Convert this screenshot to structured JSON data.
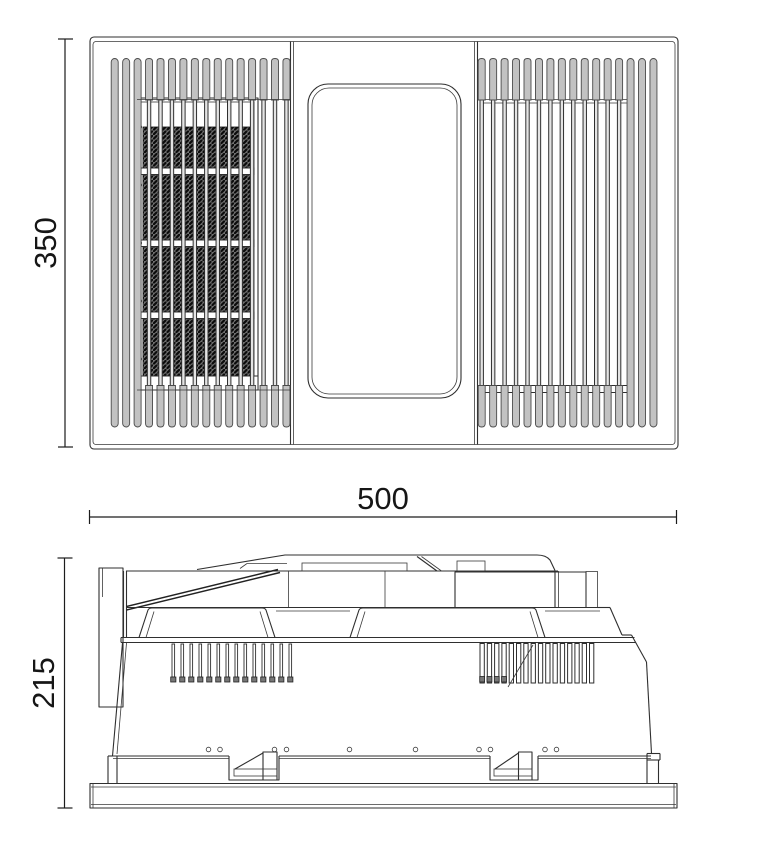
{
  "drawing": {
    "dims": {
      "front_height": "350",
      "front_width": "500",
      "side_height": "215"
    },
    "colors": {
      "line": "#2f2f2f",
      "shade_gray": "#c2c2c2",
      "element_hatch": "#0b0b0b",
      "background": "#ffffff"
    }
  }
}
